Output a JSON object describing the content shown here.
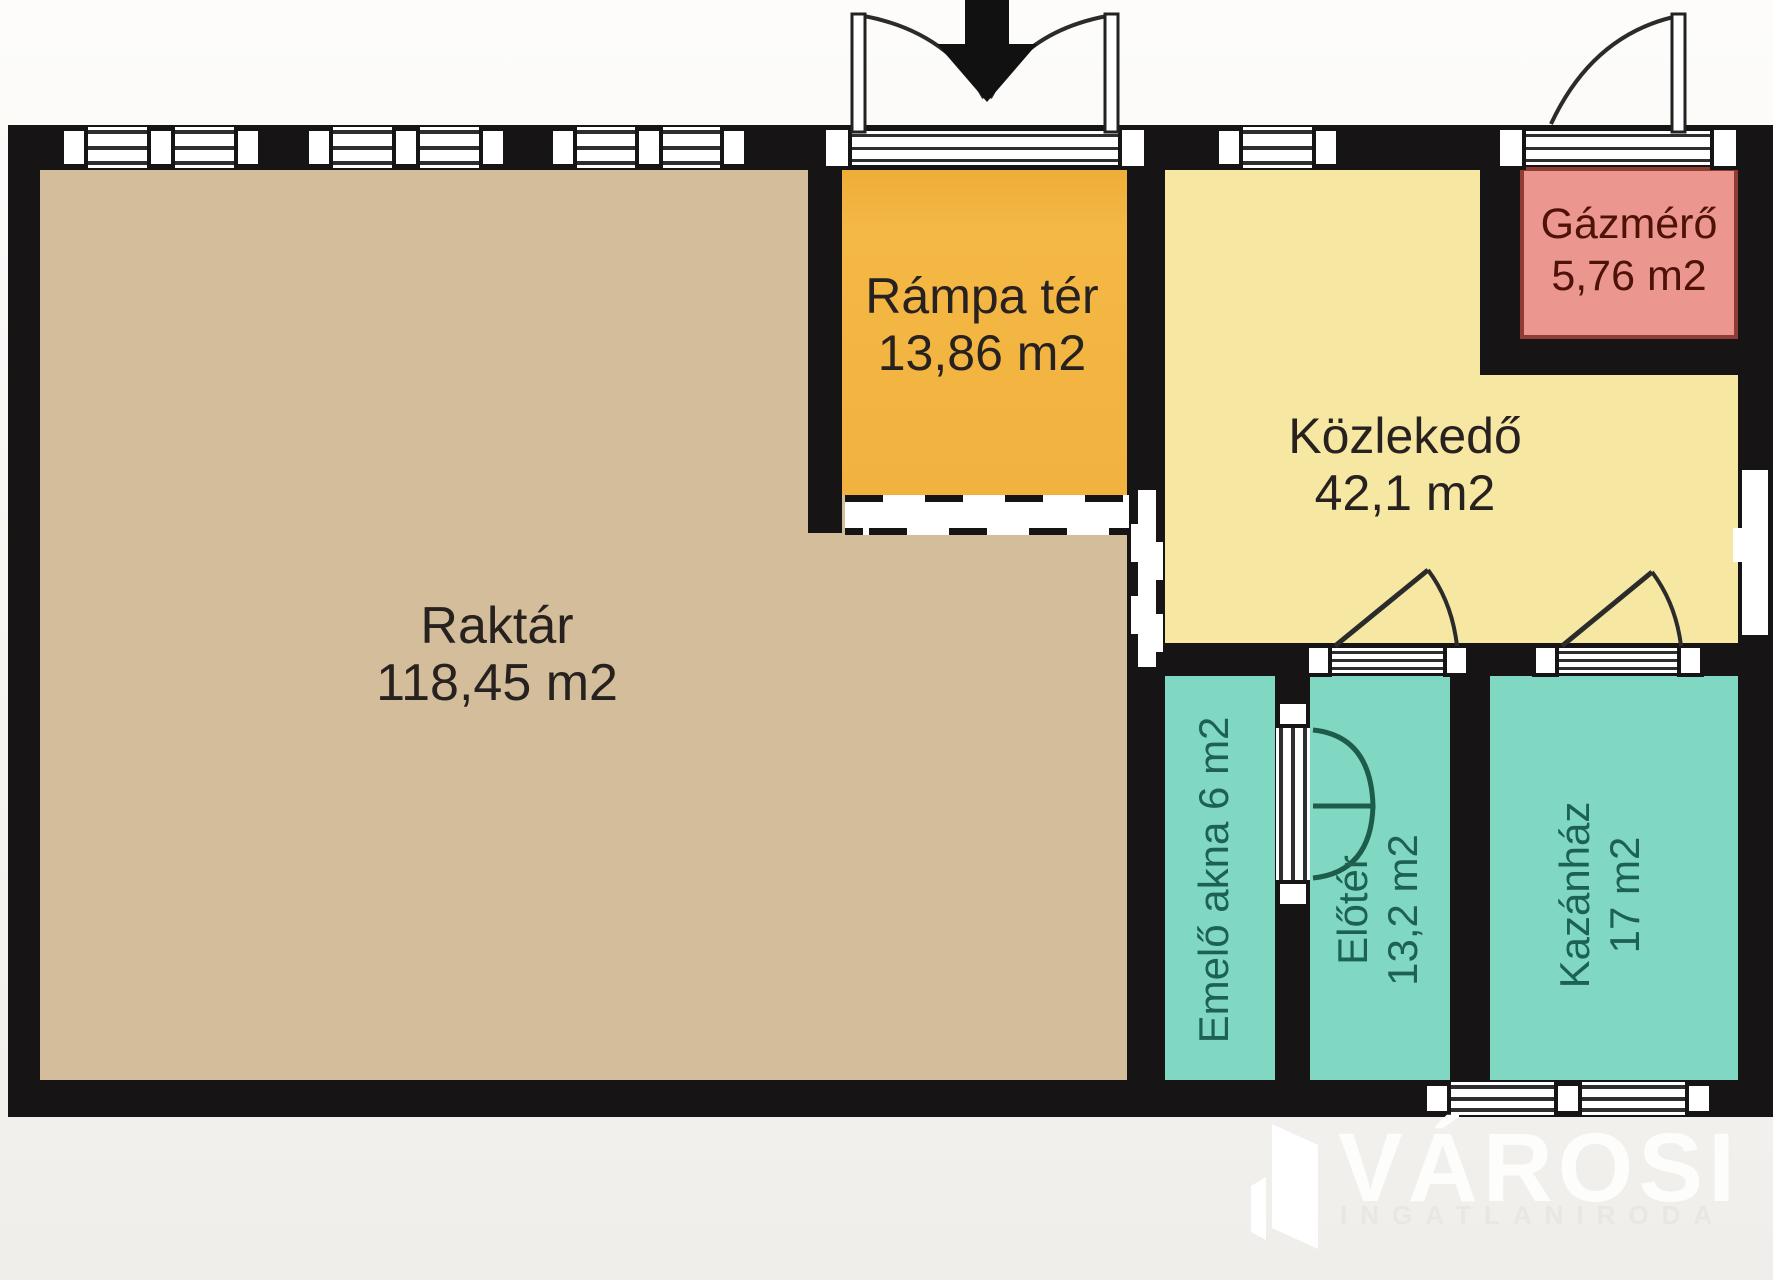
{
  "plan": {
    "type": "floor-plan",
    "wall_color": "#161414",
    "rooms": [
      {
        "id": "raktar",
        "name": "Raktár",
        "area": "118,45 m2",
        "color": "#d3bd9a",
        "label_color": "#27211f"
      },
      {
        "id": "rampa-ter",
        "name": "Rámpa tér",
        "area": "13,86 m2",
        "color": "#f2b23f",
        "label_color": "#27211f"
      },
      {
        "id": "kozlekedo",
        "name": "Közlekedő",
        "area": "42,1 m2",
        "color": "#f6e7a3",
        "label_color": "#27211f"
      },
      {
        "id": "gazmero",
        "name": "Gázmérő",
        "area": "5,76 m2",
        "color": "#eb968e",
        "label_color": "#4f1208"
      },
      {
        "id": "emelo-akna",
        "name": "Emelő akna",
        "area": "6 m2",
        "color": "#81d8c2",
        "label_color": "#1c6152"
      },
      {
        "id": "eloter",
        "name": "Előtér",
        "area": "13,2 m2",
        "color": "#81d8c2",
        "label_color": "#1c6152"
      },
      {
        "id": "kazanhaz",
        "name": "Kazánház",
        "area": "17 m2",
        "color": "#81d8c2",
        "label_color": "#1c6152"
      }
    ]
  },
  "watermark": {
    "brand": "VÁROSI",
    "tagline": "INGATLANIRODA"
  }
}
